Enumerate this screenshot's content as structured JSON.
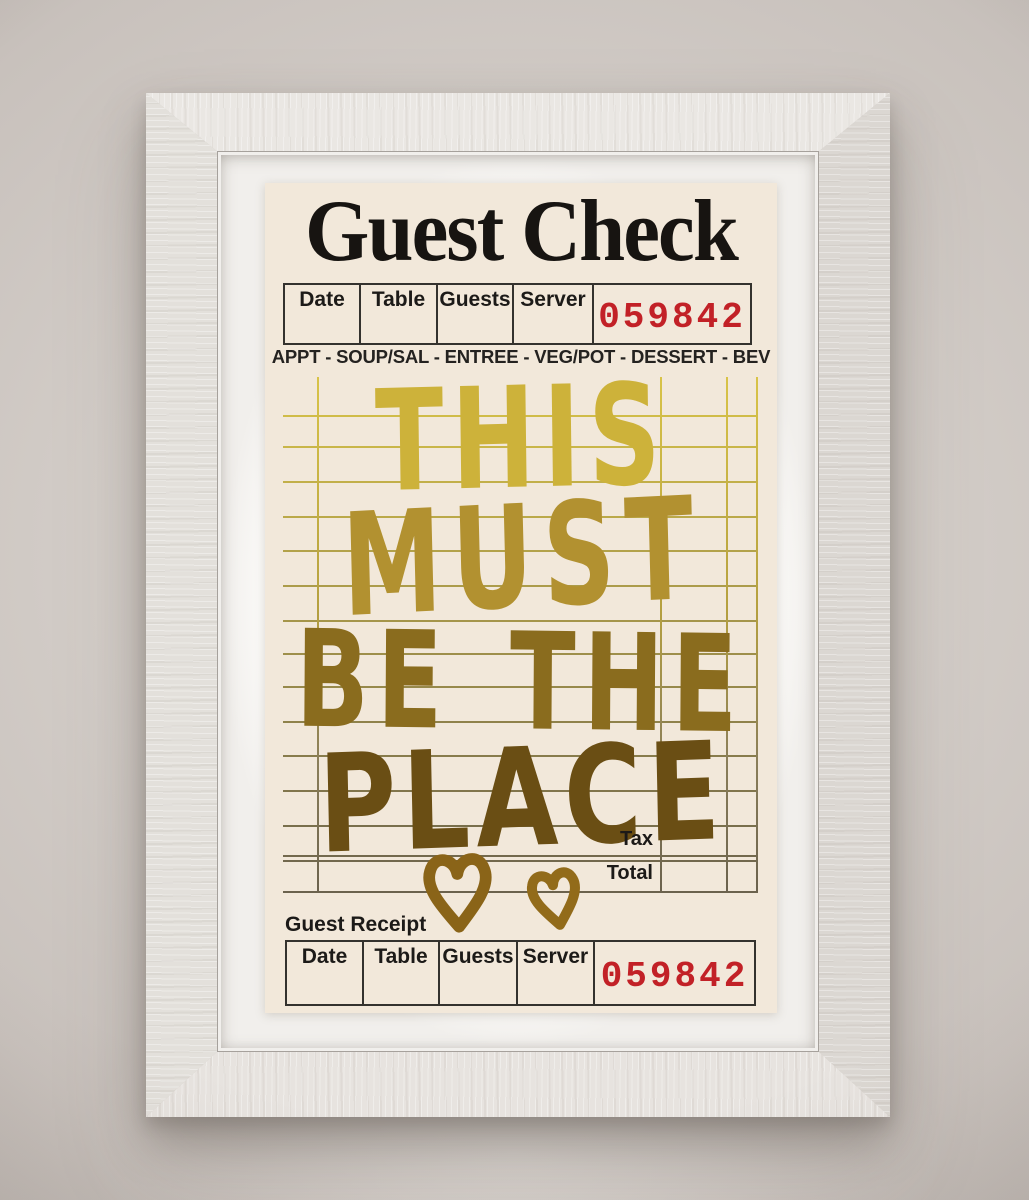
{
  "poster": {
    "title": "Guest Check",
    "check_header": {
      "columns": [
        "Date",
        "Table",
        "Guests",
        "Server"
      ],
      "check_number": "059842"
    },
    "course_line": "APPT - SOUP/SAL - ENTREE - VEG/POT - DESSERT - BEV",
    "quote_lines": [
      "THIS",
      "MUST",
      "BE THE",
      "PLACE"
    ],
    "totals": {
      "tax_label": "Tax",
      "total_label": "Total"
    },
    "receipt": {
      "label": "Guest Receipt",
      "columns": [
        "Date",
        "Table",
        "Guests",
        "Server"
      ],
      "check_number": "059842"
    }
  },
  "colors": {
    "check_number_red": "#c22127",
    "gold_top": "#d8c348",
    "gold_bottom": "#6b4e12",
    "paper_cream": "#f2e8da",
    "frame_white": "#e7e4e0",
    "line_ink": "#34322e"
  }
}
